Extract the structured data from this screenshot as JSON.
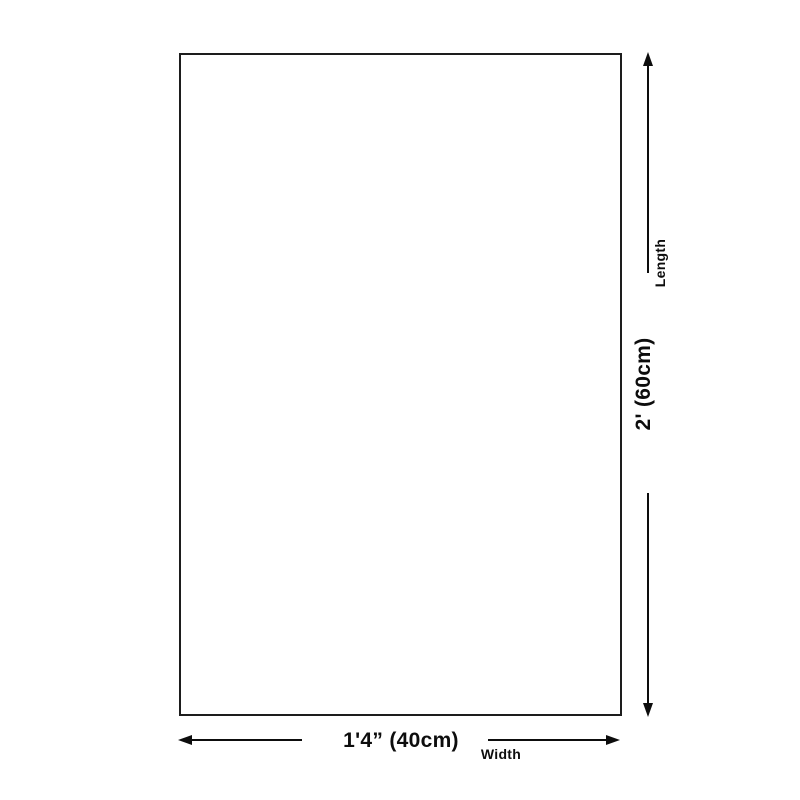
{
  "diagram": {
    "type": "product-dimension-diagram",
    "shape": "rectangle",
    "background_color": "#ffffff",
    "line_color": "#0d0d0d",
    "outline_color": "#1d1d1d",
    "length": {
      "label": "Length",
      "value": "2' (60cm)"
    },
    "width": {
      "label": "Width",
      "value": "1'4” (40cm)"
    }
  }
}
